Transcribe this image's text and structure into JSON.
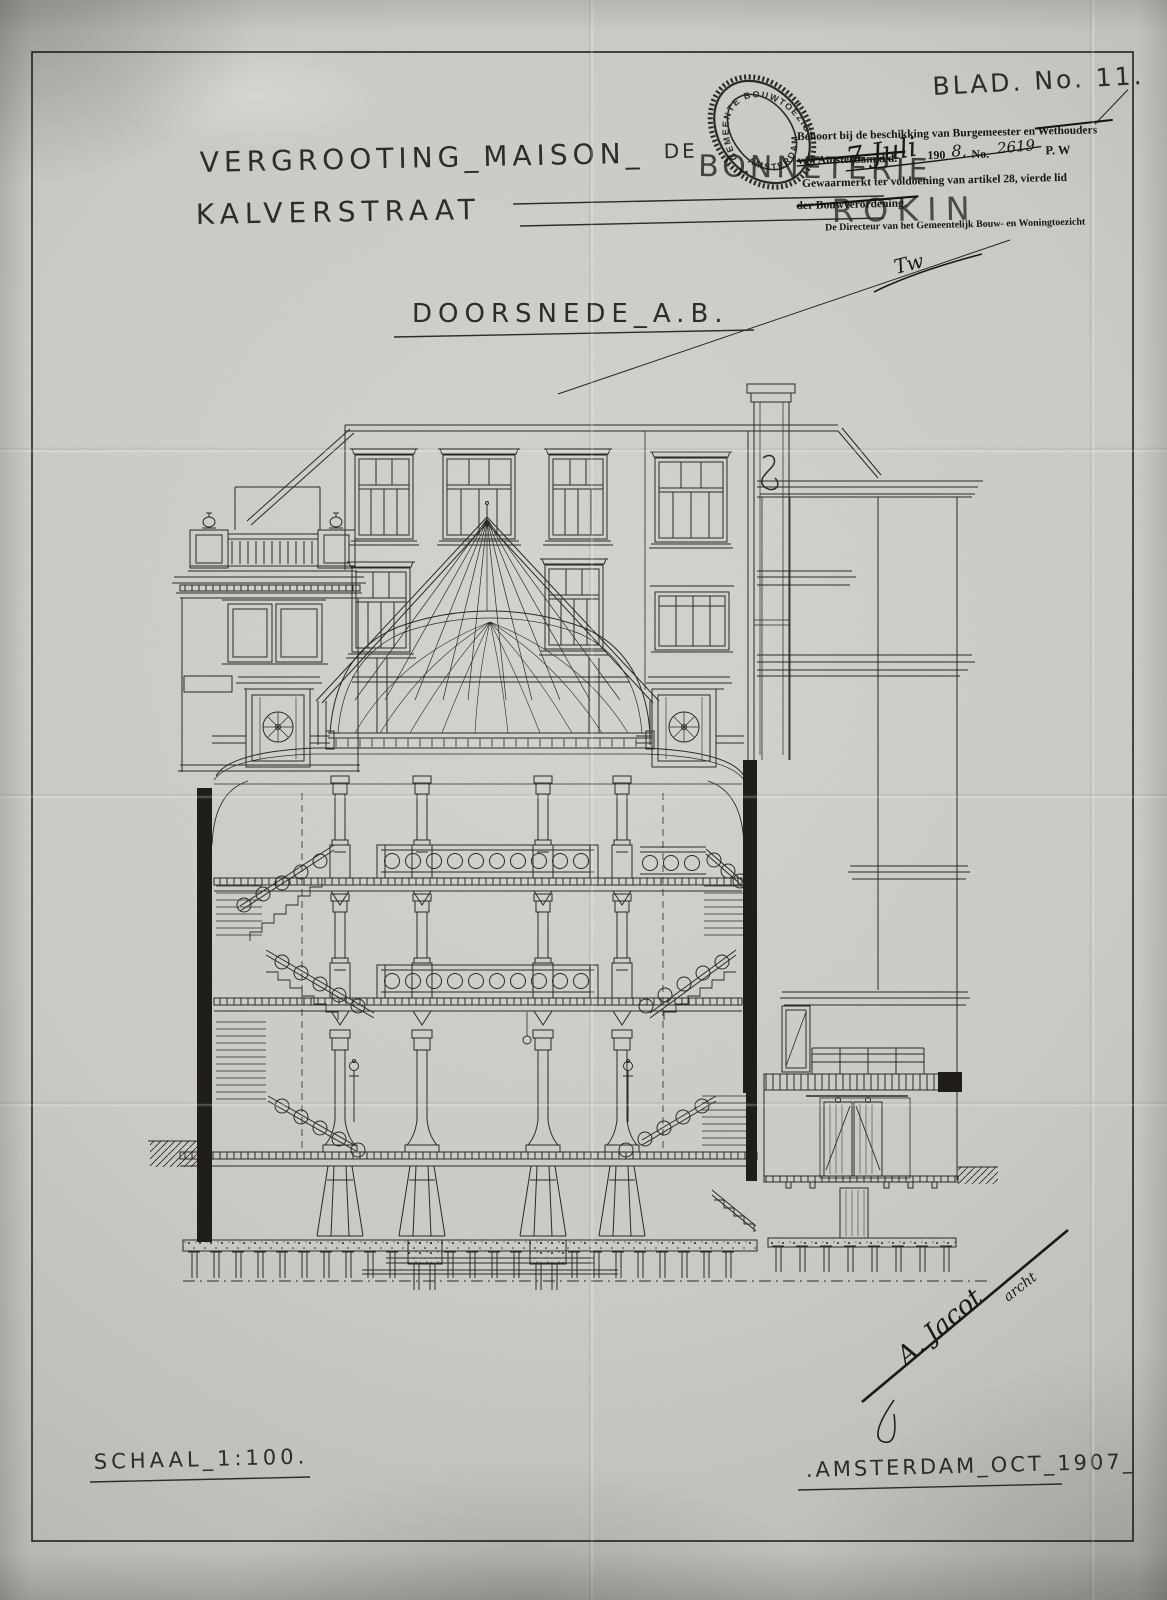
{
  "sheet": {
    "blad_no": "BLAD. No. 11.",
    "drawing_title": "DOORSNEDE_A.B.",
    "scale_label": "SCHAAL_1:100.",
    "place_date": ".AMSTERDAM_OCT_1907_"
  },
  "project_title": {
    "line1_left": "VERGROOTING_MAISON_",
    "line1_de": "DE",
    "line1_right": "BONNETERIE",
    "line2": "KALVERSTRAAT",
    "handwritten_street": "ROKIN"
  },
  "oval_stamp": {
    "arc_top": "GEMEENTE BOUWTOEZICHT",
    "arc_bottom": "AMSTERDAM"
  },
  "approval_stamp": {
    "line1": "Behoort bij de beschikking van Burgemeester en Wethouders",
    "line2_prefix": "van Amsterdam d.d.",
    "date_handwritten": "7 Juli",
    "year_printed": "190",
    "year_digit_handwritten": "8,",
    "no_label": "No.",
    "no_handwritten": "2619",
    "dept": "P. W",
    "line3": "Gewaarmerkt ter voldoening van artikel 28, vierde lid",
    "line4": "der Bouwverordening.",
    "line5": "De Directeur van het Gemeentelijk Bouw- en Woningtoezicht",
    "paraph": "Tw"
  },
  "signature": {
    "name": "A. Jacot",
    "title": "archt"
  }
}
